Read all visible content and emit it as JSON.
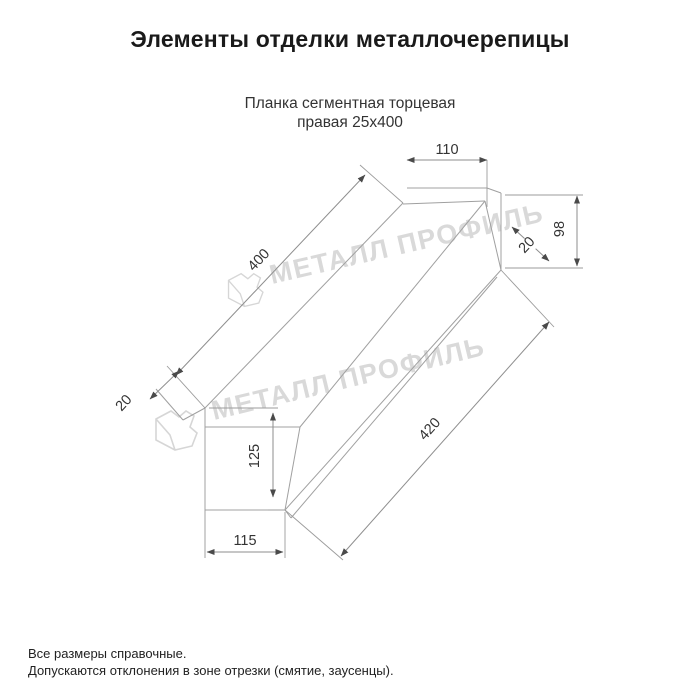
{
  "page": {
    "title": "Элементы отделки металлочерепицы"
  },
  "drawing": {
    "subtitle_line1": "Планка сегментная торцевая",
    "subtitle_line2": "правая 25х400",
    "watermark_text": "МЕТАЛЛ ПРОФИЛЬ",
    "dimensions": {
      "top_width": "110",
      "right_height": "98",
      "right_fold": "20",
      "top_length": "400",
      "bottom_length": "420",
      "left_height": "125",
      "left_width": "115",
      "left_fold": "20"
    },
    "colors": {
      "object_line": "#a0a0a0",
      "dimension_line": "#8e8e8e",
      "dimension_text": "#333333",
      "watermark": "#d9d9d9",
      "title_text": "#1a1a1a",
      "body_text": "#222222",
      "background": "#ffffff"
    }
  },
  "footer": {
    "line1": "Все размеры справочные.",
    "line2": "Допускаются отклонения в зоне отрезки (смятие, заусенцы)."
  }
}
